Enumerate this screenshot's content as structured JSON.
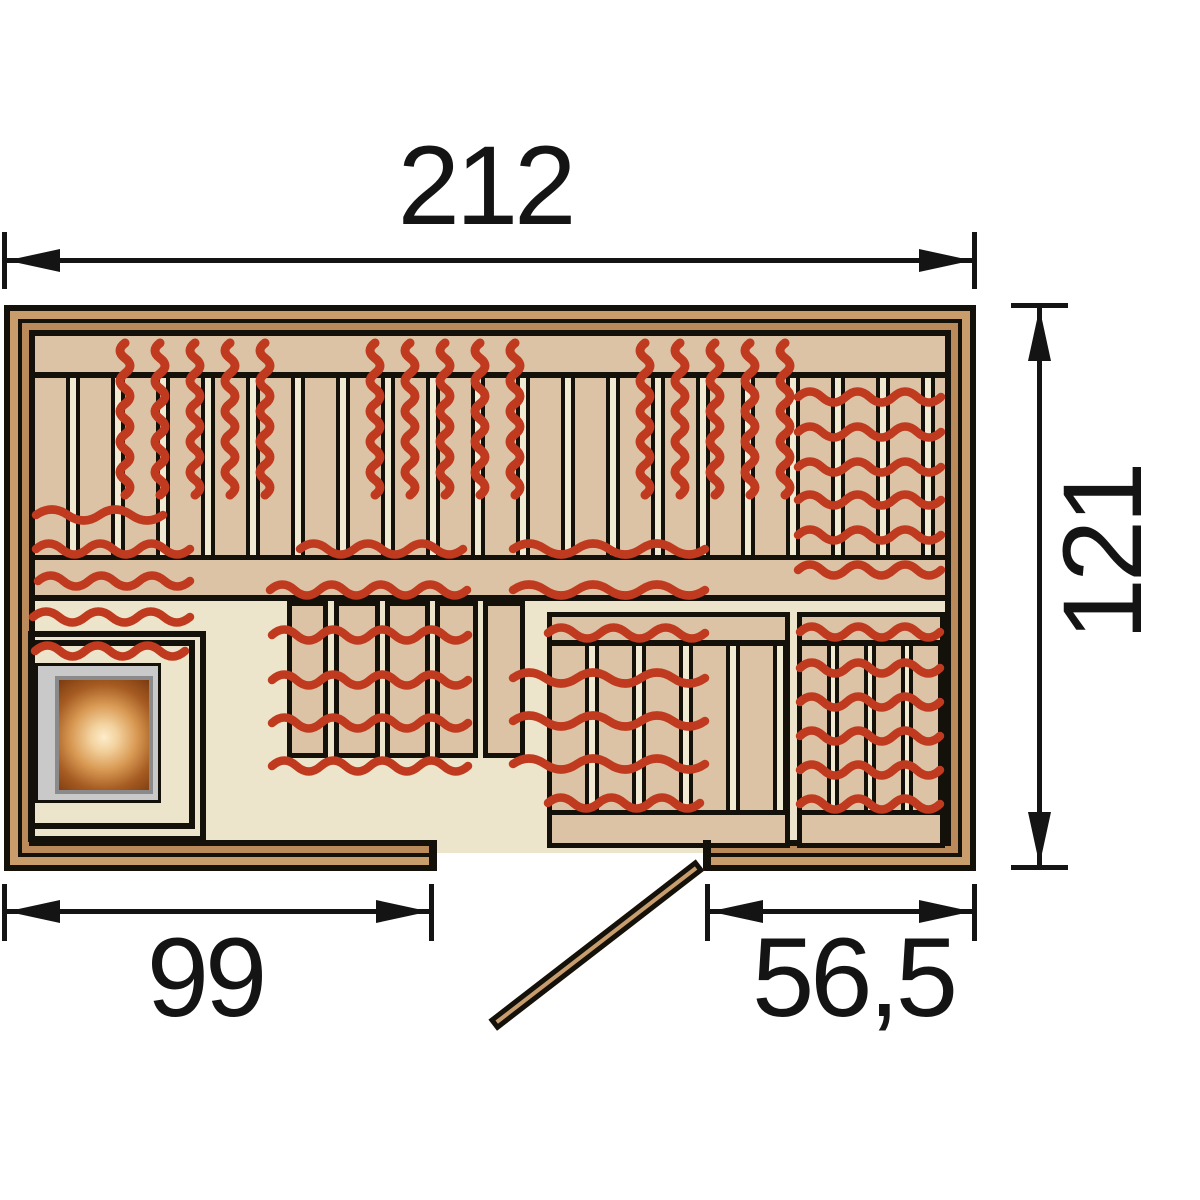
{
  "dimension_labels": {
    "overall_width": "212",
    "overall_depth": "121",
    "left_to_door": "99",
    "door_to_right": "56,5"
  },
  "colors": {
    "wall_wood_light": "#c99c6b",
    "wall_wood_dark": "#bb8a5a",
    "bench_wood": "#dcc3a5",
    "floor_cream": "#ece5cb",
    "slat_gap_cream": "#f0ead3",
    "heating_red": "#bf3a1e",
    "stove_gray": "#c9c9c9",
    "stove_glow_dark": "#7c3a10",
    "stove_glow_light": "#fdeccb",
    "door_wood": "#c79d6d",
    "outline_black": "#14100a"
  },
  "elements": {
    "heater_icon": "sauna-heater",
    "heat_marks_icon": "heat-wave-marks",
    "door_icon": "door-swing"
  }
}
